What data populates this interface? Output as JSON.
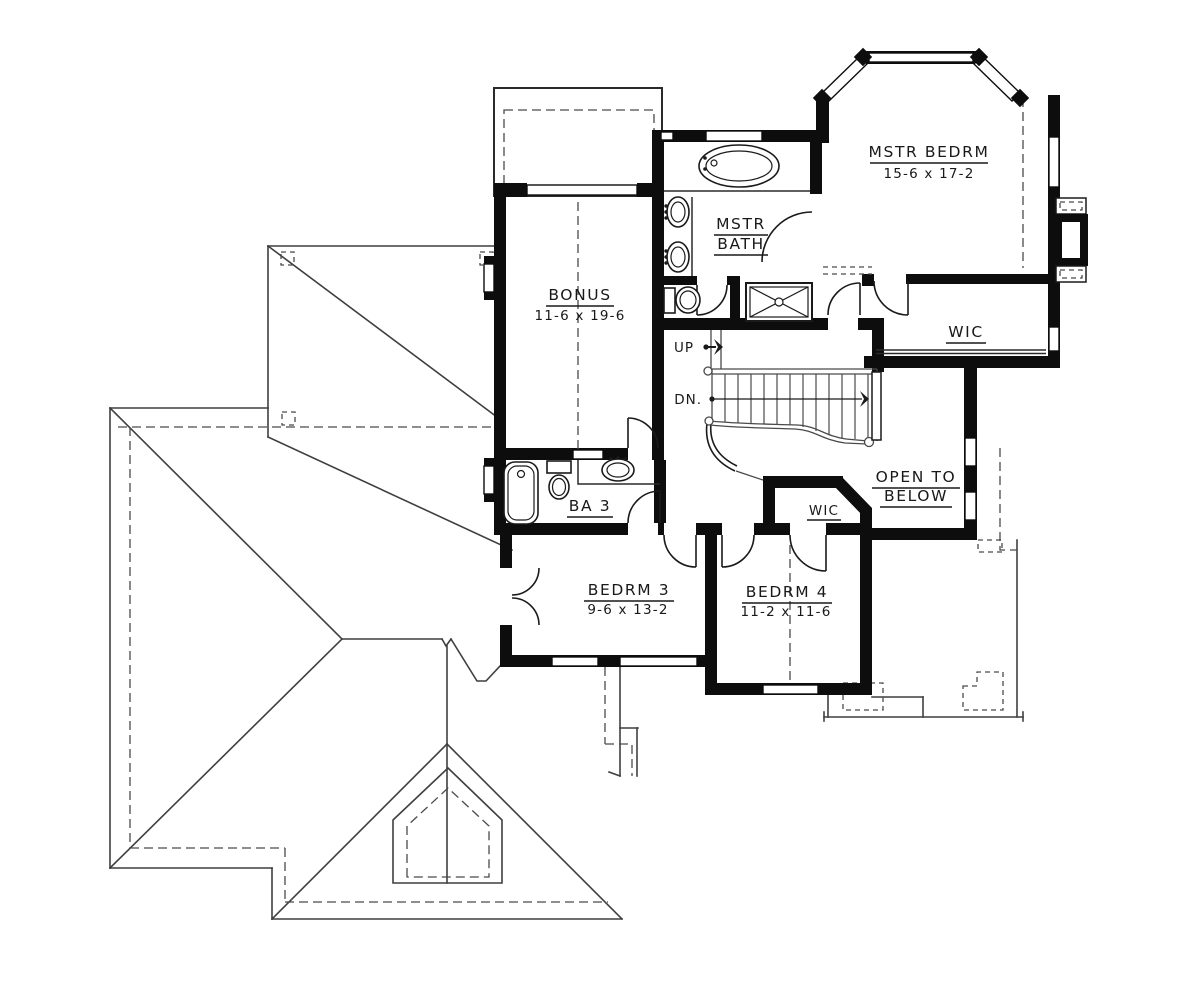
{
  "floor_plan": {
    "rooms": {
      "master_bedroom": {
        "name": "MSTR BEDRM",
        "dimensions": "15-6 x 17-2"
      },
      "master_bath": {
        "name_line1": "MSTR",
        "name_line2": "BATH"
      },
      "bonus": {
        "name": "BONUS",
        "dimensions": "11-6 x 19-6"
      },
      "master_wic": {
        "name": "WIC"
      },
      "bedroom4_wic": {
        "name": "WIC"
      },
      "open_to_below": {
        "name_line1": "OPEN TO",
        "name_line2": "BELOW"
      },
      "bath3": {
        "name": "BA 3"
      },
      "bedroom3": {
        "name": "BEDRM 3",
        "dimensions": "9-6 x 13-2"
      },
      "bedroom4": {
        "name": "BEDRM 4",
        "dimensions": "11-2 x 11-6"
      }
    },
    "stairs": {
      "up": "UP",
      "down": "DN."
    },
    "colors": {
      "walls": "#0d0d0d",
      "roof_lines": "#3f3f3f",
      "background": "#ffffff"
    }
  }
}
